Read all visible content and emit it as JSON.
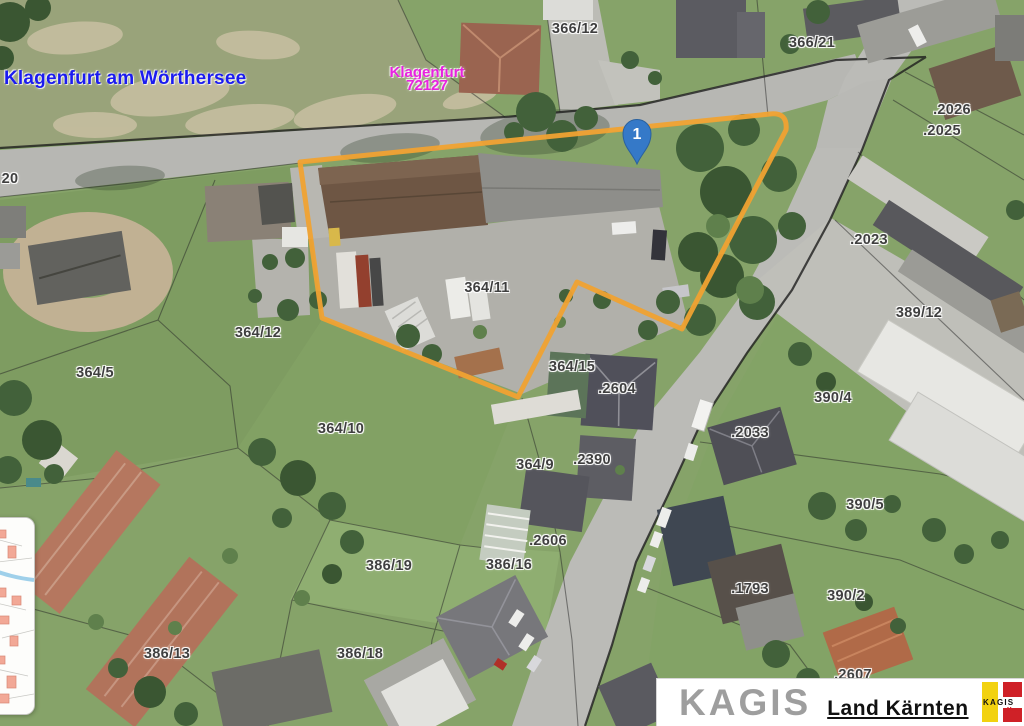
{
  "map": {
    "municipality_label": "Klagenfurt am Wörthersee",
    "cadastral_area": {
      "name": "Klagenfurt",
      "code": "72127"
    },
    "marker": {
      "number": "1"
    },
    "colors": {
      "highlight": "#f0a232",
      "marker_fill": "#3579c8",
      "marker_stroke": "#2a619e",
      "municipality_text": "#1b1bf0",
      "cadastral_text": "#e822e0",
      "parcel_text": "#3f3f3f",
      "logo_yellow": "#f2d210",
      "logo_red": "#cf2127"
    },
    "parcels": [
      {
        "label": "366/12",
        "x": 575,
        "y": 29
      },
      {
        "label": "366/21",
        "x": 812,
        "y": 43
      },
      {
        "label": ".2026",
        "x": 952,
        "y": 110
      },
      {
        "label": ".2025",
        "x": 942,
        "y": 131
      },
      {
        "label": ".2023",
        "x": 869,
        "y": 240
      },
      {
        "label": "389/12",
        "x": 919,
        "y": 313
      },
      {
        "label": "390/4",
        "x": 833,
        "y": 398
      },
      {
        "label": "364/11",
        "x": 487,
        "y": 288
      },
      {
        "label": "364/12",
        "x": 258,
        "y": 333
      },
      {
        "label": "364/5",
        "x": 95,
        "y": 373
      },
      {
        "label": "364/10",
        "x": 341,
        "y": 429
      },
      {
        "label": "364/15",
        "x": 572,
        "y": 367
      },
      {
        "label": ".2604",
        "x": 617,
        "y": 389
      },
      {
        "label": "364/9",
        "x": 535,
        "y": 465
      },
      {
        "label": ".2390",
        "x": 592,
        "y": 460
      },
      {
        "label": ".2033",
        "x": 750,
        "y": 433
      },
      {
        "label": ".2606",
        "x": 548,
        "y": 541
      },
      {
        "label": "386/16",
        "x": 509,
        "y": 565
      },
      {
        "label": "386/19",
        "x": 389,
        "y": 566
      },
      {
        "label": "390/5",
        "x": 865,
        "y": 505
      },
      {
        "label": ".1793",
        "x": 750,
        "y": 589
      },
      {
        "label": "390/2",
        "x": 846,
        "y": 596
      },
      {
        "label": "386/13",
        "x": 167,
        "y": 654
      },
      {
        "label": "386/18",
        "x": 360,
        "y": 654
      },
      {
        "label": ".2607",
        "x": 853,
        "y": 675
      },
      {
        "label": "20",
        "x": 10,
        "y": 179
      }
    ]
  },
  "footer": {
    "brand": "KAGIS",
    "org": "Land Kärnten",
    "logo": {
      "text": "KAGIS",
      "subtext": "Maps"
    }
  }
}
